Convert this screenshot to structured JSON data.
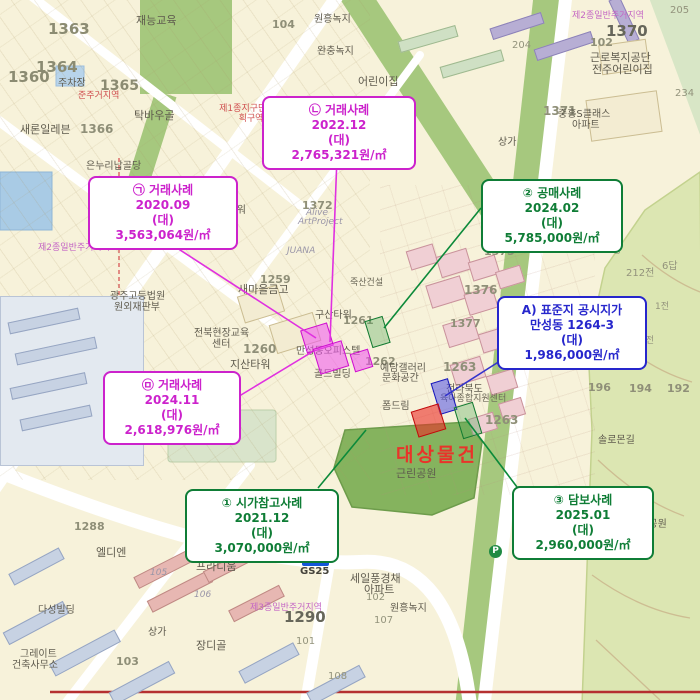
{
  "map": {
    "subject": {
      "label": "대상물건"
    },
    "callouts": [
      {
        "name": "sale-2020-09",
        "lines": [
          "㉠ 거래사례",
          "2020.09",
          "(대)",
          "3,563,064원/㎡"
        ]
      },
      {
        "name": "sale-2022-12",
        "lines": [
          "㉡ 거래사례",
          "2022.12",
          "(대)",
          "2,765,321원/㎡"
        ]
      },
      {
        "name": "public-auction",
        "lines": [
          "② 공매사례",
          "2024.02",
          "(대)",
          "5,785,000원/㎡"
        ]
      },
      {
        "name": "standard-lot-price",
        "lines": [
          "A) 표준지 공시지가",
          "만성동 1264-3",
          "(대)",
          "1,986,000원/㎡"
        ]
      },
      {
        "name": "sale-2024-11",
        "lines": [
          "㉤ 거래사례",
          "2024.11",
          "(대)",
          "2,618,976원/㎡"
        ]
      },
      {
        "name": "market-reference",
        "lines": [
          "① 시가참고사례",
          "2021.12",
          "(대)",
          "3,070,000원/㎡"
        ]
      },
      {
        "name": "collateral-case",
        "lines": [
          "③ 담보사례",
          "2025.01",
          "(대)",
          "2,960,000원/㎡"
        ]
      }
    ],
    "poi": {
      "gs25_badge": "GS25",
      "gs25_text": "GS25",
      "parking": "P"
    },
    "colors": {
      "magenta": "#cc22cc",
      "green": "#0f7d36",
      "blue": "#2626cc",
      "subject_red": "#e8342a"
    },
    "labels": [
      {
        "text": "1363"
      },
      {
        "text": "1364"
      },
      {
        "text": "1360"
      },
      {
        "text": "1365"
      },
      {
        "text": "1366"
      },
      {
        "text": "104"
      },
      {
        "text": "102"
      },
      {
        "text": "205"
      },
      {
        "text": "204"
      },
      {
        "text": "1370"
      },
      {
        "text": "1371"
      },
      {
        "text": "234"
      },
      {
        "text": "1452공"
      },
      {
        "text": "212전"
      },
      {
        "text": "6답"
      },
      {
        "text": "1전"
      },
      {
        "text": "4전"
      },
      {
        "text": "196"
      },
      {
        "text": "194"
      },
      {
        "text": "192"
      },
      {
        "text": "1290"
      },
      {
        "text": "1288"
      },
      {
        "text": "1259"
      },
      {
        "text": "1260"
      },
      {
        "text": "1261"
      },
      {
        "text": "1262"
      },
      {
        "text": "1263"
      },
      {
        "text": "1263"
      },
      {
        "text": "1372"
      },
      {
        "text": "1375"
      },
      {
        "text": "1376"
      },
      {
        "text": "1377"
      },
      {
        "text": "103"
      },
      {
        "text": "101"
      },
      {
        "text": "108"
      },
      {
        "text": "102"
      },
      {
        "text": "107"
      },
      {
        "text": "105"
      },
      {
        "text": "106"
      },
      {
        "text": "재능교육"
      },
      {
        "text": "탁바우골"
      },
      {
        "text": "새론일레븐"
      },
      {
        "text": "주차장"
      },
      {
        "text": "완충녹지"
      },
      {
        "text": "원흥녹지"
      },
      {
        "text": "어린이집"
      },
      {
        "text": "근로복지공단"
      },
      {
        "text": "전주어린이집"
      },
      {
        "text": "중흥S클래스"
      },
      {
        "text": "아파트"
      },
      {
        "text": "은누리납골당"
      },
      {
        "text": "제2종일반주거지역"
      },
      {
        "text": "제2종일반주거지역"
      },
      {
        "text": "제3종일반주거지역"
      },
      {
        "text": "제1종지구단위계획구역"
      },
      {
        "text": "준주거지역"
      },
      {
        "text": "광주고등법원"
      },
      {
        "text": "원외재판부"
      },
      {
        "text": "새마을금고"
      },
      {
        "text": "JUANA"
      },
      {
        "text": "Alive"
      },
      {
        "text": "ArtProject"
      },
      {
        "text": "구산타워"
      },
      {
        "text": "지산타워"
      },
      {
        "text": "만성동오피스텔"
      },
      {
        "text": "골드빌딩"
      },
      {
        "text": "전북현장교육"
      },
      {
        "text": "센터"
      },
      {
        "text": "죽산건설"
      },
      {
        "text": "예담갤러리"
      },
      {
        "text": "문화공간"
      },
      {
        "text": "폼드림"
      },
      {
        "text": "전라북도"
      },
      {
        "text": "육아종합지원센터"
      },
      {
        "text": "근린공원"
      },
      {
        "text": "근린공원"
      },
      {
        "text": "장디골"
      },
      {
        "text": "상가"
      },
      {
        "text": "상가"
      },
      {
        "text": "세일풍경채"
      },
      {
        "text": "아파트"
      },
      {
        "text": "전주만성지구"
      },
      {
        "text": "프라디움"
      },
      {
        "text": "엘디엔"
      },
      {
        "text": "다성빌딩"
      },
      {
        "text": "그레이트"
      },
      {
        "text": "건축사무소"
      },
      {
        "text": "원흥녹지"
      },
      {
        "text": "석류공원"
      },
      {
        "text": "솔로몬길"
      },
      {
        "text": "이티빌딩"
      },
      {
        "text": "H타워"
      }
    ]
  }
}
